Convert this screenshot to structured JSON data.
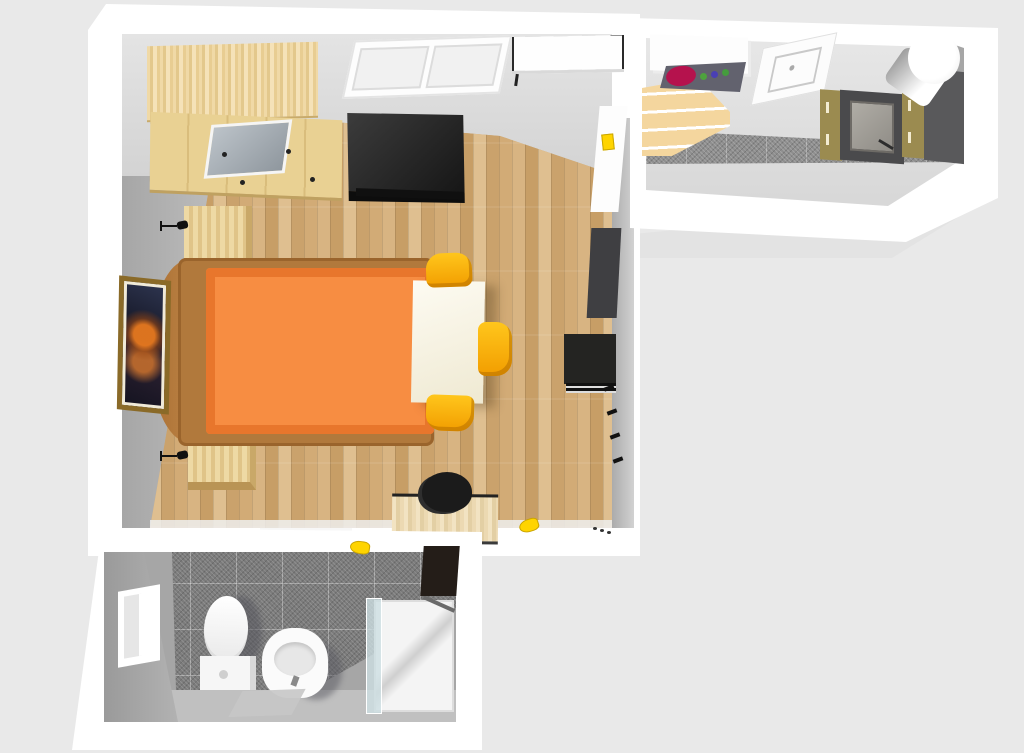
{
  "scene": {
    "description": "3D rendered top-down floor plan of a studio apartment with bedroom-living room, kitchen corridor and bathroom",
    "visible_text": "none"
  },
  "colors": {
    "background": "#e9e9e9",
    "shadow": "#e3e3e3",
    "wall_white": "#ffffff",
    "wood_floor": "#cfa772",
    "bed_frame": "#b1793c",
    "mattress": "#f78d42",
    "mattress_edge": "#e8762c",
    "accent_yellow": "#ffd400",
    "tile_gray": "#7b7b7b",
    "burner_red": "#b5124d",
    "cabinet_khaki": "#9b8b50",
    "oven_gray": "#4a4a4c",
    "fridge_gray": "#59595b",
    "dark_unit": "#3f3f42",
    "black_unit": "#242422",
    "frame_gold": "#8a6a28"
  },
  "rooms": {
    "bedroom": {
      "name": "bedroom-living-room",
      "floor": "light wood parquet",
      "furniture": {
        "wardrobe": "Wardrobe with mirror door",
        "window": "Double casement window",
        "wall_cabinet": "White wall cabinet",
        "tv": "Flat-screen TV",
        "door": "Door to kitchen corridor",
        "light_switch": "Yellow light switch",
        "bed": "Double bed with orange cover",
        "nightstand_top": "Nightstand",
        "nightstand_bottom": "Nightstand",
        "lamp_top": "Table lamp",
        "lamp_bottom": "Table lamp",
        "table": "White dining table",
        "chair_top": "Yellow chair",
        "chair_right": "Yellow chair",
        "chair_bottom": "Yellow chair",
        "picture": "Framed butterfly picture",
        "shelf_tall": "Tall gray shelf",
        "stereo": "Black stereo cabinet",
        "coat_hooks": "Wall coat hooks",
        "desk": "Wooden desk",
        "office_chair": "Black office chair",
        "slipper": "Yellow slipper",
        "shoes": "Pair of shoes"
      }
    },
    "kitchen": {
      "name": "kitchen-corridor",
      "floor": "gray tiles with light screed",
      "furniture": {
        "counter": "White counter",
        "cooktop": "Cooktop with red burner and knobs",
        "sink": "Flush kitchen sink",
        "shelves": "Open wooden shelves",
        "cabinet_left": "Khaki base cabinet",
        "oven": "Built-in oven",
        "cabinet_right": "Khaki base cabinet",
        "fridge": "Tall dark fridge unit",
        "boiler": "Round water boiler"
      }
    },
    "bathroom": {
      "name": "bathroom",
      "floor": "dark gray speckled tiles",
      "furniture": {
        "window": "Bathroom window",
        "toilet": "Toilet with cistern",
        "bidet": "Bidet",
        "shower": "Glass shower enclosure",
        "cabinet": "Dark bathroom cabinet",
        "mat": "Bath mat",
        "slipper": "Yellow slipper at doorway"
      }
    }
  }
}
